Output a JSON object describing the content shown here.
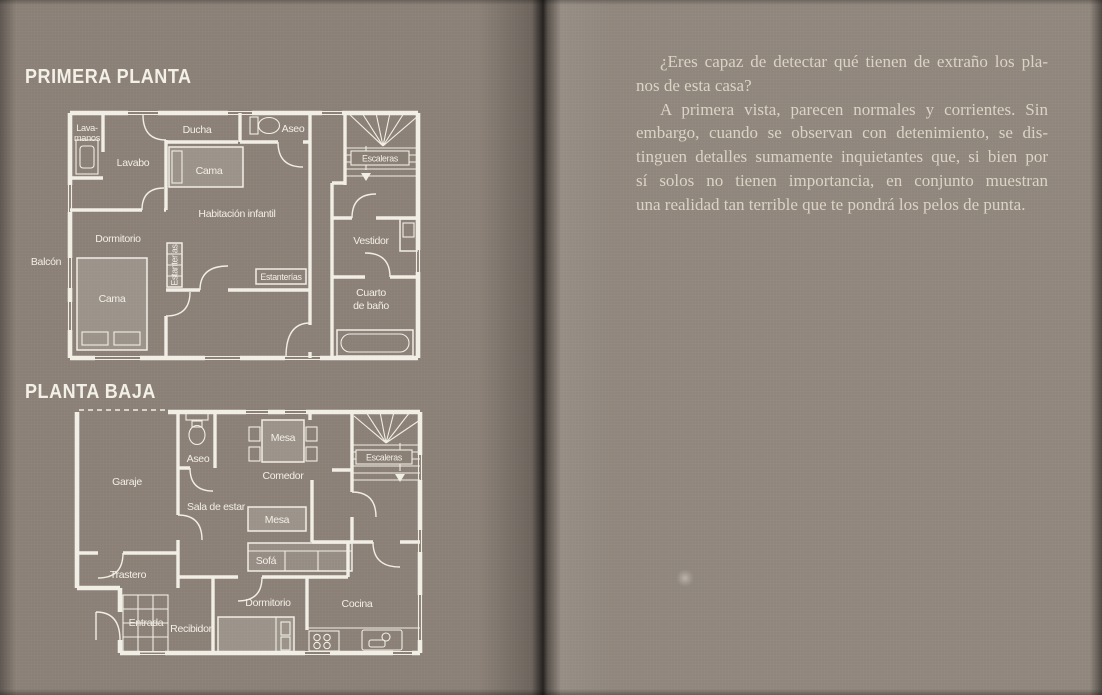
{
  "left_page": {
    "plan_upper": {
      "title": "PRIMERA PLANTA",
      "labels": {
        "lavamanos_line1": "Lava-",
        "lavamanos_line2": "manos",
        "ducha": "Ducha",
        "aseo": "Aseo",
        "escaleras": "Escaleras",
        "lavabo": "Lavabo",
        "cama_infantil": "Cama",
        "habitacion_infantil": "Habitación infantil",
        "dormitorio": "Dormitorio",
        "balcon": "Balcón",
        "cama": "Cama",
        "estanterias_izq": "Estanterías",
        "estanterias_inf": "Estanterías",
        "vestidor": "Vestidor",
        "cuarto_bano_line1": "Cuarto",
        "cuarto_bano_line2": "de baño"
      }
    },
    "plan_lower": {
      "title": "PLANTA BAJA",
      "labels": {
        "garaje": "Garaje",
        "aseo": "Aseo",
        "mesa_comedor": "Mesa",
        "comedor": "Comedor",
        "escaleras": "Escaleras",
        "sala_de_estar": "Sala de estar",
        "mesa_sala": "Mesa",
        "sofa": "Sofá",
        "trastero": "Trastero",
        "entrada": "Entrada",
        "recibidor": "Recibidor",
        "dormitorio": "Dormitorio",
        "cocina": "Cocina"
      }
    }
  },
  "right_page": {
    "lines": [
      "¿Eres capaz de detectar qué tienen de extraño los pla-",
      "nos de esta casa?",
      "A primera vista, parecen normales y corrientes. Sin",
      "embargo, cuando se observan con detenimiento, se dis-",
      "tinguen detalles sumamente inquietantes que, si bien por",
      "sí solos no tienen importancia, en conjunto muestran",
      "una realidad tan terrible que te pondrá los pelos de punta."
    ]
  },
  "colors": {
    "page_left": "#8a8076",
    "page_right": "#8f867c",
    "gutter_shadow": "#262220",
    "plan_ink": "#f1eee5",
    "body_text": "#dbd4c5"
  }
}
